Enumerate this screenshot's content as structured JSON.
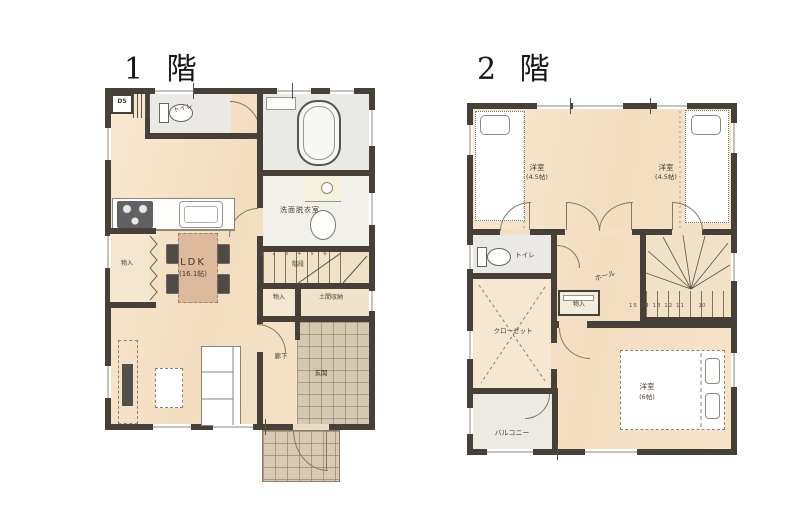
{
  "colors": {
    "wall": "#474039",
    "floor": "#f6e5cc",
    "wet_floor": "#eae9e4",
    "tile": "#d5c8b2",
    "table_accent": "#ddb99e"
  },
  "floor1": {
    "title": "1 階",
    "labels": {
      "ds": "DS",
      "toilet": "トイレ",
      "washroom": "洗面脱衣室",
      "stair_numbers": "1 2 3 4 5 6",
      "stairs": "階段",
      "storage_hall": "物入",
      "doma_storage": "土間収納",
      "hallway": "廊下",
      "entrance": "玄関",
      "storage_kitchen": "物入",
      "ldk_name": "LDK",
      "ldk_size": "(16.1帖)"
    }
  },
  "floor2": {
    "title": "2 階",
    "labels": {
      "bedroom_left_name": "洋室",
      "bedroom_left_size": "(4.5帖)",
      "bedroom_right_name": "洋室",
      "bedroom_right_size": "(4.5帖)",
      "toilet": "トイレ",
      "hall": "ホール",
      "storage": "物入",
      "closet": "クローゼット",
      "stair_numbers": "15 14 13 12 11",
      "stair_number_last": "10",
      "bedroom_main_name": "洋室",
      "bedroom_main_size": "(6帖)",
      "balcony": "バルコニー"
    }
  }
}
